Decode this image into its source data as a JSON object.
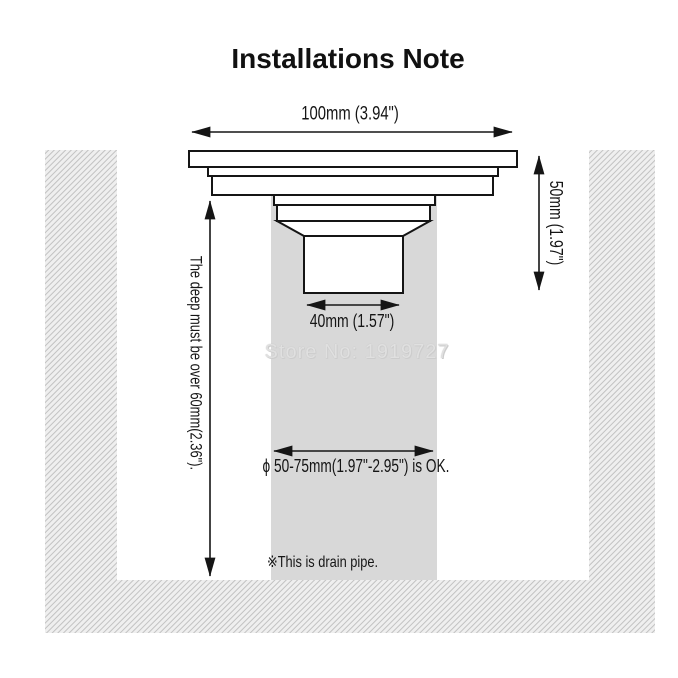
{
  "title": "Installations Note",
  "diagram": {
    "dim_width_top": "100mm (3.94\")",
    "dim_height_right": "50mm (1.97\")",
    "dim_outlet_width": "40mm (1.57\")",
    "dim_depth_note": "The deep must be over 60mm(2.36\").",
    "dim_pipe_diameter": "ϕ 50-75mm(1.97\"-2.95\") is OK.",
    "note_drain_pipe": "※This is drain pipe.",
    "watermark": "Store No: 1919727",
    "colors": {
      "line": "#151515",
      "pipe_fill": "#d8d8d8",
      "hatch_line": "#c2c2c2",
      "hatch_background": "#efefef",
      "fixture_fill": "#ffffff",
      "watermark_text": "#e0e0e0"
    }
  }
}
